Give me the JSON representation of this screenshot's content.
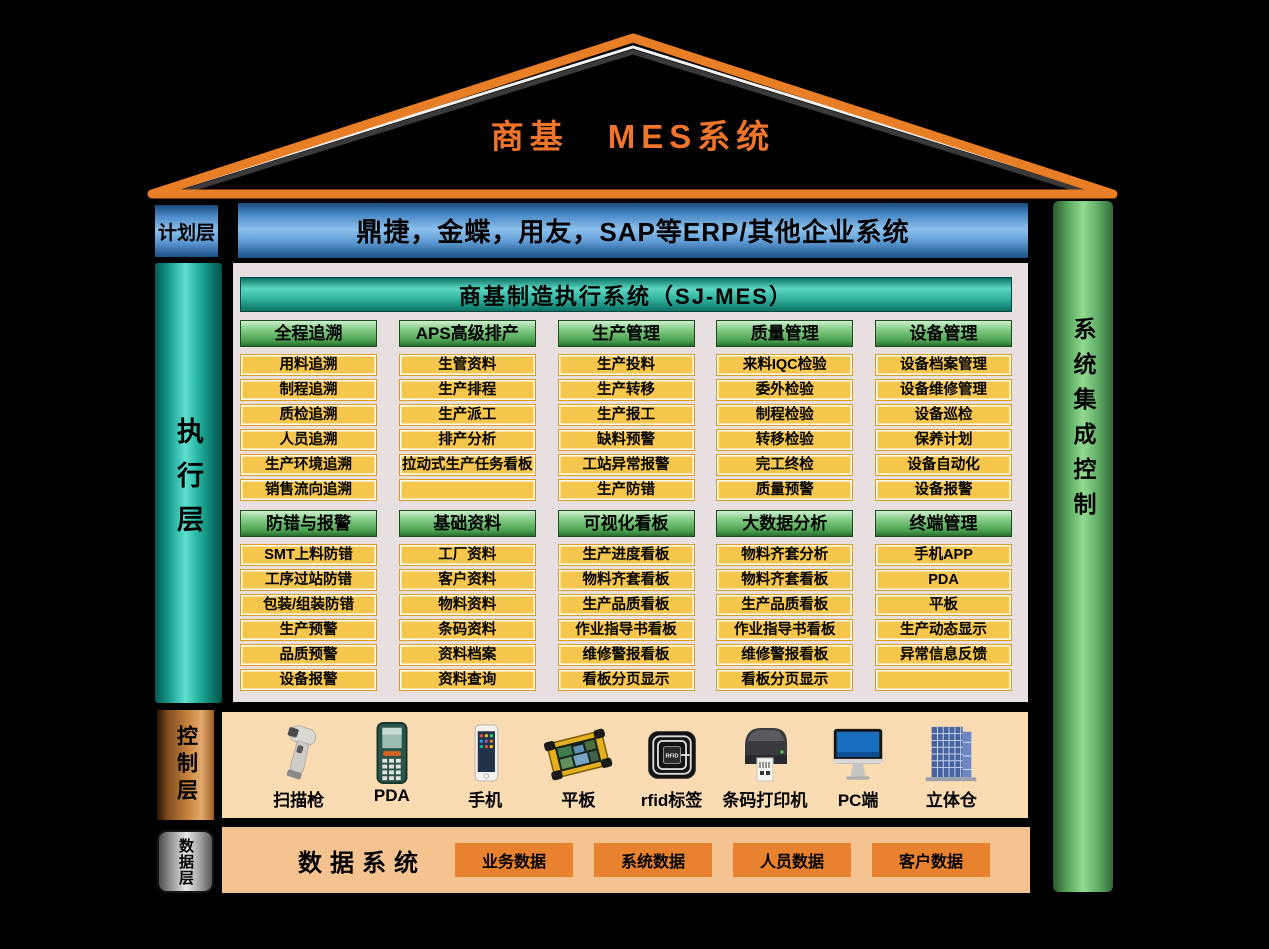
{
  "title": "商基　MES系统",
  "planning_layer": {
    "label": "计划层",
    "erp_bar": "鼎捷，金蝶，用友，SAP等ERP/其他企业系统"
  },
  "execution_layer": {
    "label": "执行层"
  },
  "right_bar": {
    "label": "系统集成控制"
  },
  "mes": {
    "header": "商基制造执行系统（SJ-MES）",
    "modules": [
      {
        "title": "全程追溯",
        "items": [
          "用料追溯",
          "制程追溯",
          "质检追溯",
          "人员追溯",
          "生产环境追溯",
          "销售流向追溯"
        ]
      },
      {
        "title": "APS高级排产",
        "items": [
          "生管资料",
          "生产排程",
          "生产派工",
          "排产分析",
          "拉动式生产任务看板",
          ""
        ]
      },
      {
        "title": "生产管理",
        "items": [
          "生产投料",
          "生产转移",
          "生产报工",
          "缺料预警",
          "工站异常报警",
          "生产防错"
        ]
      },
      {
        "title": "质量管理",
        "items": [
          "来料IQC检验",
          "委外检验",
          "制程检验",
          "转移检验",
          "完工终检",
          "质量预警"
        ]
      },
      {
        "title": "设备管理",
        "items": [
          "设备档案管理",
          "设备维修管理",
          "设备巡检",
          "保养计划",
          "设备自动化",
          "设备报警"
        ]
      },
      {
        "title": "防错与报警",
        "items": [
          "SMT上料防错",
          "工序过站防错",
          "包装/组装防错",
          "生产预警",
          "品质预警",
          "设备报警"
        ]
      },
      {
        "title": "基础资料",
        "items": [
          "工厂资料",
          "客户资料",
          "物料资料",
          "条码资料",
          "资料档案",
          "资料查询"
        ]
      },
      {
        "title": "可视化看板",
        "items": [
          "生产进度看板",
          "物料齐套看板",
          "生产品质看板",
          "作业指导书看板",
          "维修警报看板",
          "看板分页显示"
        ]
      },
      {
        "title": "大数据分析",
        "items": [
          "物料齐套分析",
          "物料齐套看板",
          "生产品质看板",
          "作业指导书看板",
          "维修警报看板",
          "看板分页显示"
        ]
      },
      {
        "title": "终端管理",
        "items": [
          "手机APP",
          "PDA",
          "平板",
          "生产动态显示",
          "异常信息反馈",
          ""
        ]
      }
    ]
  },
  "control_layer": {
    "label": "控制层",
    "devices": [
      {
        "label": "扫描枪",
        "icon": "scanner-gun-icon"
      },
      {
        "label": "PDA",
        "icon": "pda-icon"
      },
      {
        "label": "手机",
        "icon": "phone-icon"
      },
      {
        "label": "平板",
        "icon": "tablet-icon"
      },
      {
        "label": "rfid标签",
        "icon": "rfid-tag-icon"
      },
      {
        "label": "条码打印机",
        "icon": "barcode-printer-icon"
      },
      {
        "label": "PC端",
        "icon": "pc-monitor-icon"
      },
      {
        "label": "立体仓",
        "icon": "warehouse-icon"
      }
    ]
  },
  "data_layer": {
    "label": "数据层",
    "system_label": "数据系统",
    "buttons": [
      "业务数据",
      "系统数据",
      "人员数据",
      "客户数据"
    ]
  },
  "colors": {
    "roof_orange": "#e87e26",
    "title_orange": "#f0752a",
    "erp_blue": "#4c8cc8",
    "mes_teal": "#30b09c",
    "header_green": "#48a04e",
    "cell_yellow": "#f6c64d",
    "cell_border": "#dd9d18",
    "panel_gray": "#e8e0e0",
    "control_peach": "#fbdbb2",
    "data_peach": "#f4c390",
    "data_button_orange": "#e8822f",
    "integration_green": "#92da92",
    "execution_teal": "#5fe0d0",
    "control_copper": "#c98540"
  }
}
